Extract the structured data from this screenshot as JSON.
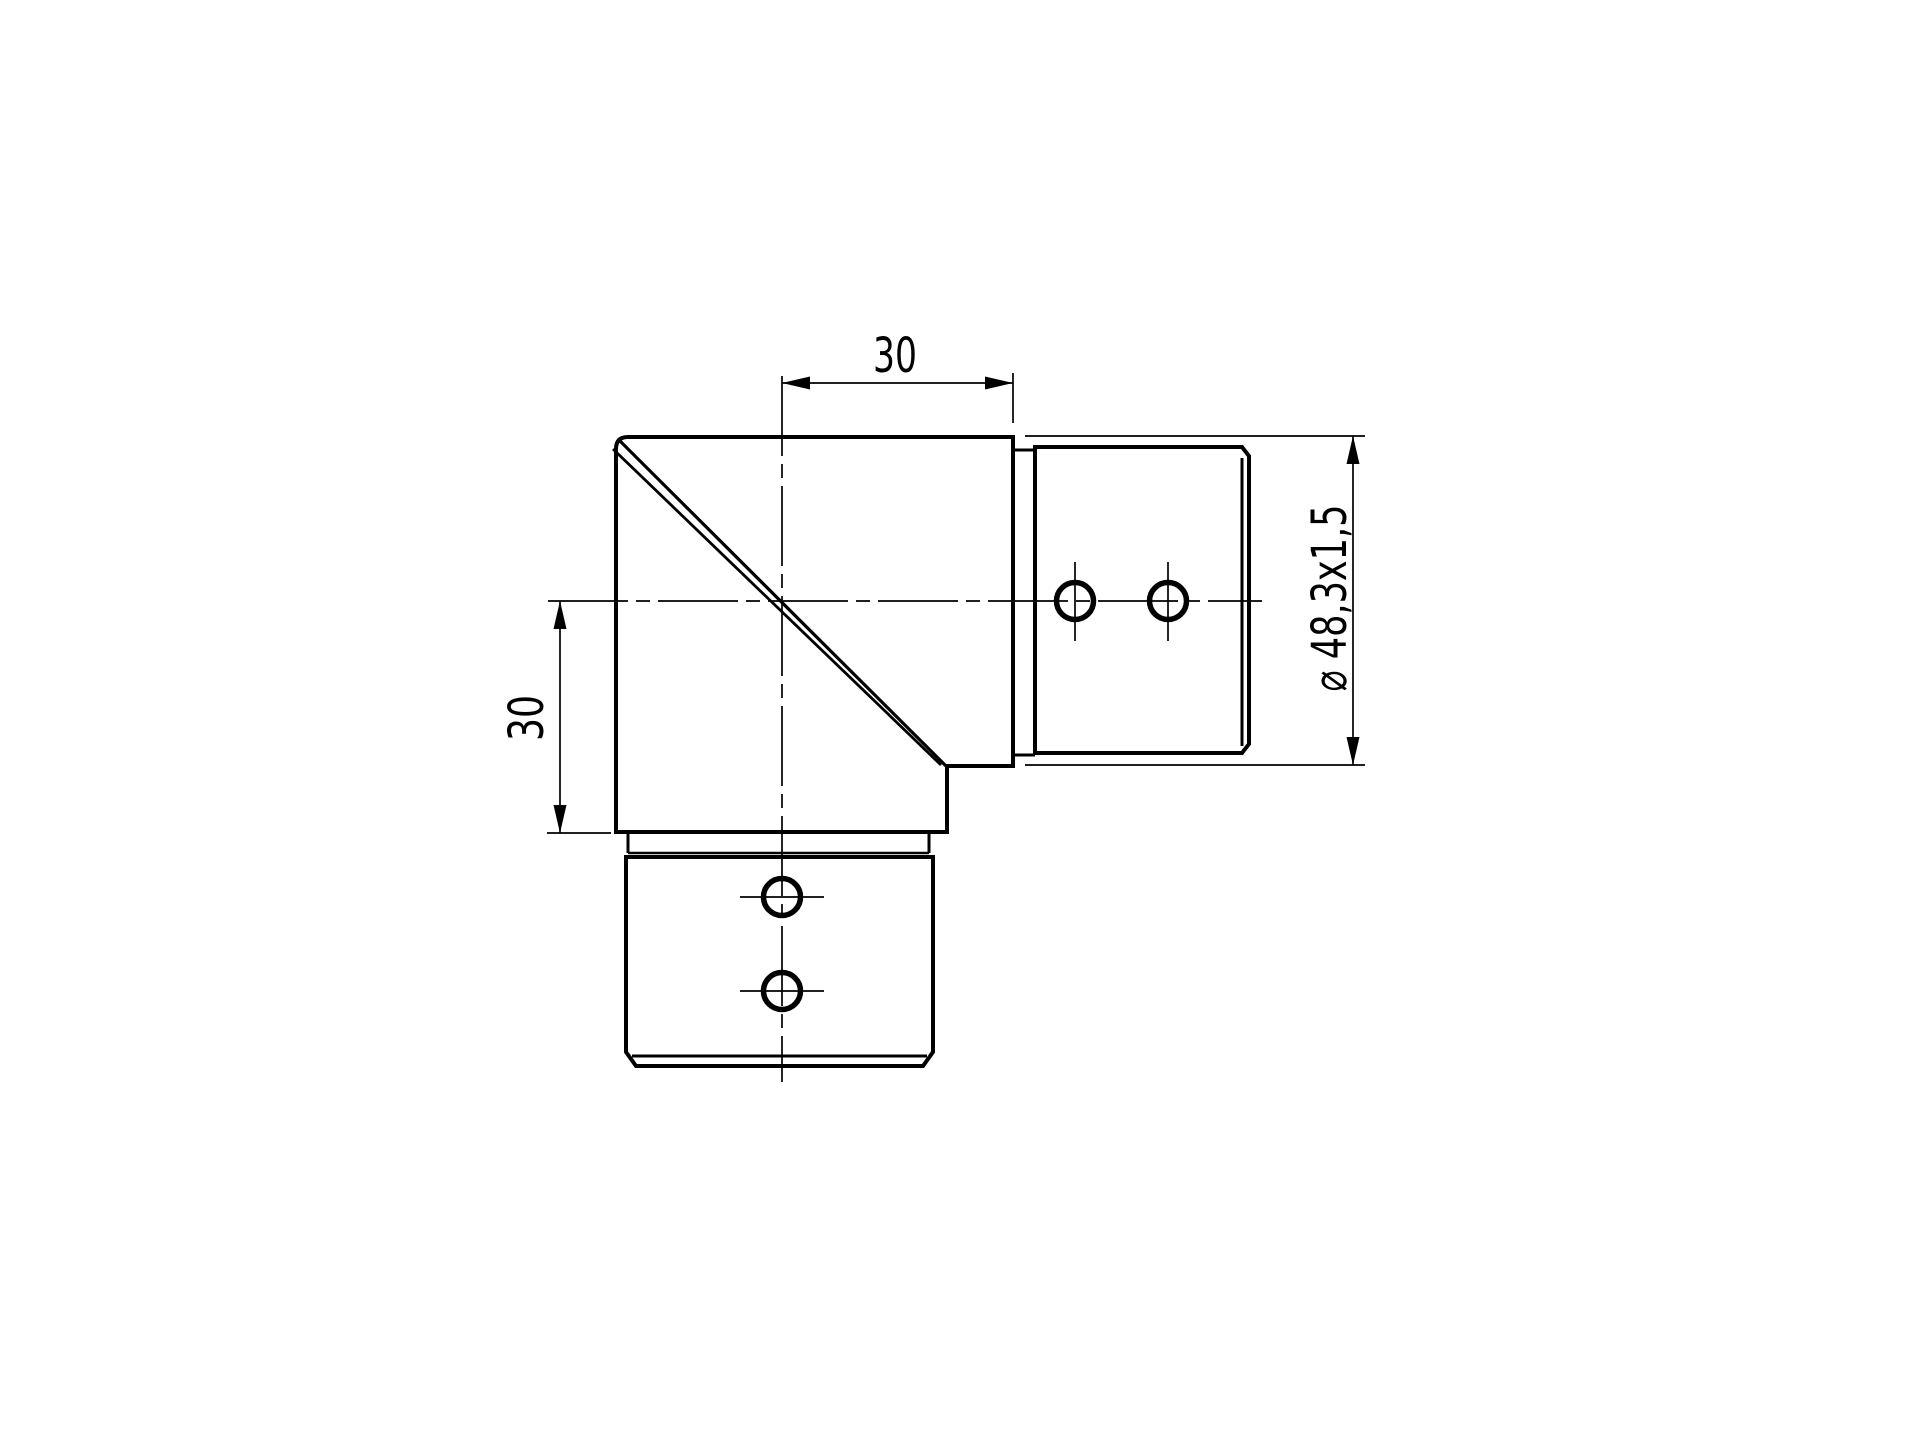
{
  "drawing": {
    "kind": "engineering-dimension-drawing",
    "dimensions": {
      "top_width": {
        "label": "30"
      },
      "left_height": {
        "label": "30"
      },
      "tube_diameter": {
        "label": "⌀ 48,3x1,5"
      }
    },
    "colors": {
      "line": "#000000",
      "background": "#ffffff"
    }
  }
}
